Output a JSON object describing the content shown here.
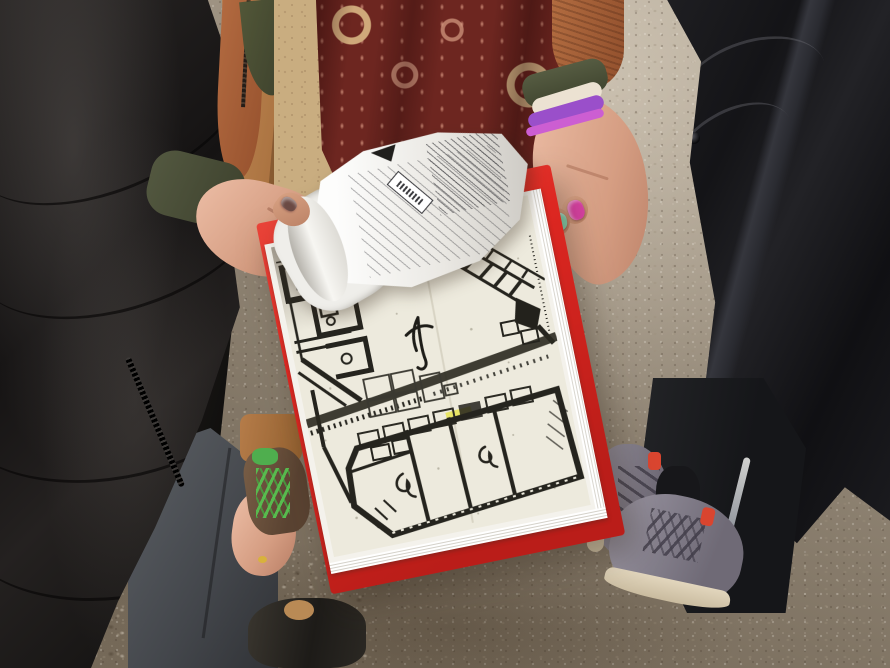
{
  "scene": {
    "description": "Outdoor photo on a gravel path: three people stand together while the centre person, wearing a burgundy-and-cream paisley shawl over a camel coat, holds a bright red folder of white printed sheets showing a photocopied black-and-white archaeological site plan; a curled ruled recording form (text illegible) is flipped over the top, and an open hand with pink, mint and gold painted nails gestures beside the map.",
    "ground": {
      "type": "gravel path",
      "base_color": "#9a8e7d"
    },
    "people": {
      "left": {
        "garment": "black quilted puffer jacket",
        "garment_color": "#1a1817",
        "jeans_color": "#53565b",
        "hand": "bare hand at side",
        "shoe": "dark shoe"
      },
      "center": {
        "coat": "camel coat",
        "coat_color": "#b5804e",
        "mid_layer": "rust knit jacket",
        "mid_layer_color": "#a8643c",
        "inner_layer": "olive green top",
        "inner_layer_color": "#4b5037",
        "scarf": "burgundy and cream paisley shawl with beige floral panel and tasselled fringe",
        "scarf_main_color": "#6d2620",
        "scarf_accent_color": "#d3b183",
        "scarf_panel_color": "#c9ad80",
        "bracelets": {
          "cream": "#ece2d2",
          "purple": "#9a4fca",
          "pink": "#cc5ed2"
        },
        "nails": {
          "pink": "#da41a4",
          "mint": "#84d2ae",
          "gold": "#a18c41",
          "left_thumb": "#6b4a44"
        },
        "boot": "brown boot with green laces",
        "boot_color": "#6b513c",
        "lace_color": "#57c04f",
        "sock_color": "#4fae4e"
      },
      "right": {
        "garment": "black rain shell with crossbody strap",
        "garment_color": "#18181b",
        "pants": "black track pants with reflective stripe",
        "pants_color": "#1c1d1f",
        "shoes": "grey trainers with cream soles and red heel tabs",
        "shoe_color": "#8f8a97",
        "sole_color": "#dbcfb6",
        "shoe_tab_color": "#d9452f"
      }
    },
    "clipboard": {
      "folder_color": "#dd2721",
      "folder_type": "red folder",
      "pages": "stack of white printed sheets",
      "map": "photocopied archaeological site plan in black ink",
      "map_paper_color": "#edeadd",
      "map_ink_color": "#25241e",
      "map_highlight_color": "#e6e448",
      "top_sheet": "curled white recording form with ruled table, text illegible"
    }
  }
}
